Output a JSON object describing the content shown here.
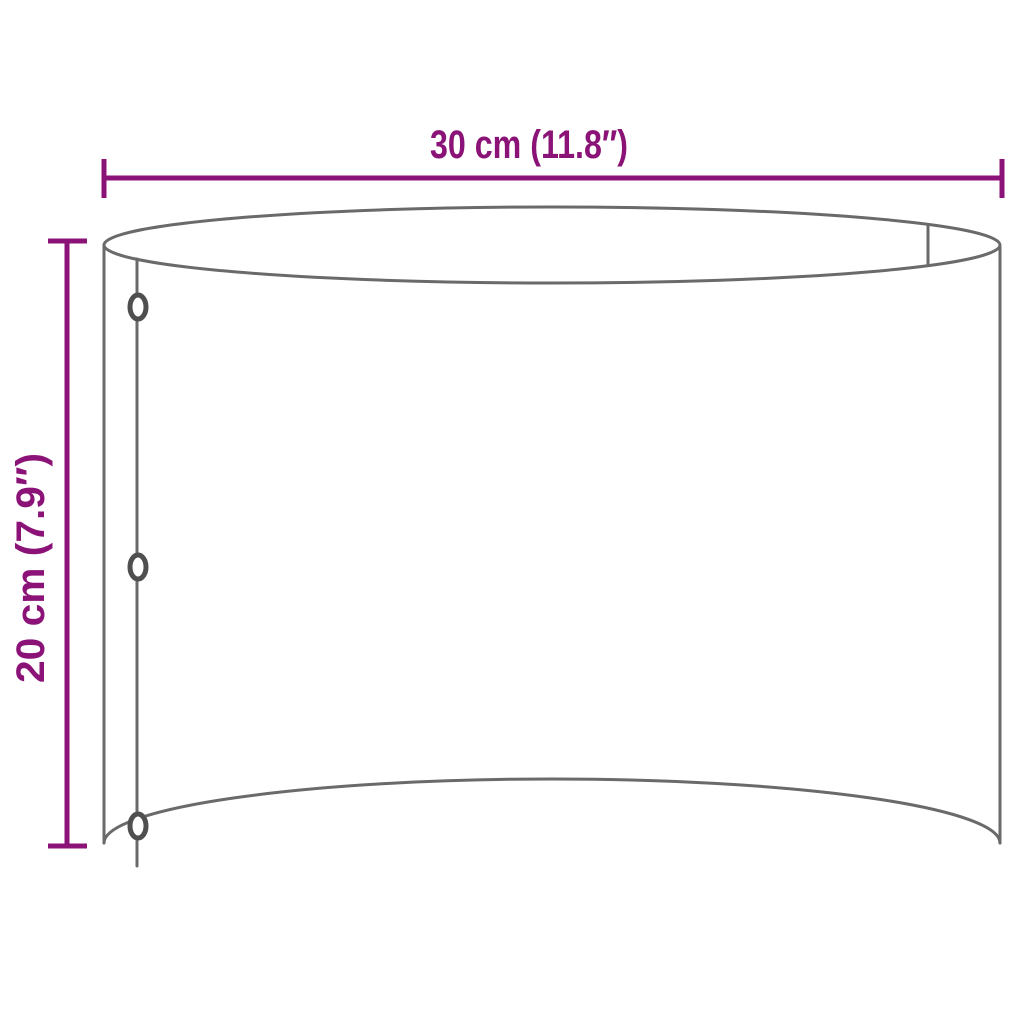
{
  "diagram": {
    "width_dimension": {
      "label": "30 cm (11.8″)"
    },
    "height_dimension": {
      "label": "20 cm (7.9″)"
    },
    "colors": {
      "dimension_accent": "#8B1377",
      "outline": "#6A6A6A",
      "rivet": "#4F4F4F",
      "background": "#FFFFFF"
    }
  }
}
